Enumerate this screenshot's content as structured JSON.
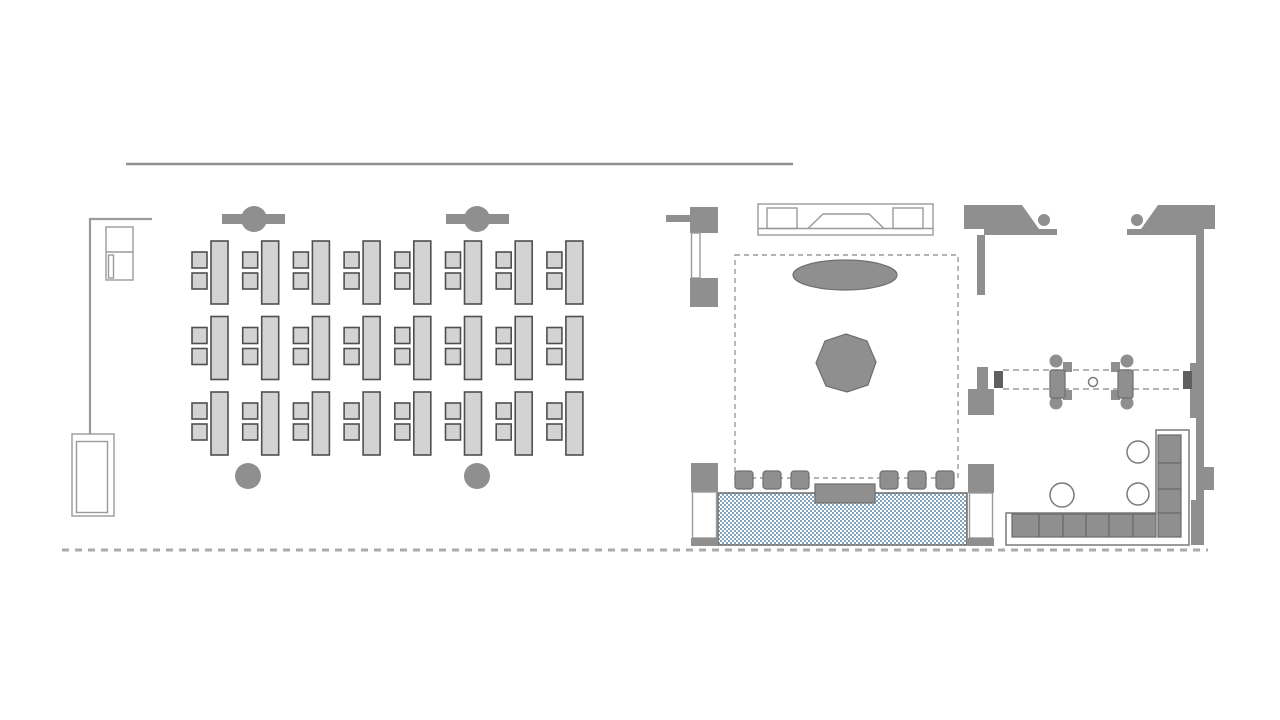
{
  "plan": {
    "kind": "office-floor-plan",
    "areas": {
      "classroom": {
        "desk_units": 24,
        "chairs_per_desk": 2,
        "columns_with_beam": 2,
        "columns_plain": 2,
        "cabinet": 1,
        "lectern": 1
      },
      "lounge": {
        "stage_console": 1,
        "rug_oval": 1,
        "center_table_octagon": 1,
        "ottoman_stools": 6,
        "coffee_table": 1,
        "planter_strip": 1,
        "door_leaves": 3
      },
      "cafe": {
        "service_counters": 2,
        "bistro_tables": 2,
        "stools_per_table": 2,
        "sofa_segments": 10,
        "round_side_tables": 3
      }
    }
  },
  "grids": {
    "classroom_desks": {
      "rows": 3,
      "cols": 8
    }
  },
  "palette": {
    "background": "#ffffff",
    "solid_gray": "#8f8f8f",
    "light_fill": "#d3d3d3",
    "dark_outline": "#4f4f4f",
    "line_gray": "#9a9a9a",
    "line_gray2": "#7a7a7a",
    "jamb_dark": "#5f5f5f",
    "segment_edge": "#6a6a6a",
    "octagon_edge": "#6f6f6f",
    "planter_blue": "#84a3bc",
    "perimeter_dash": "#ababab"
  }
}
